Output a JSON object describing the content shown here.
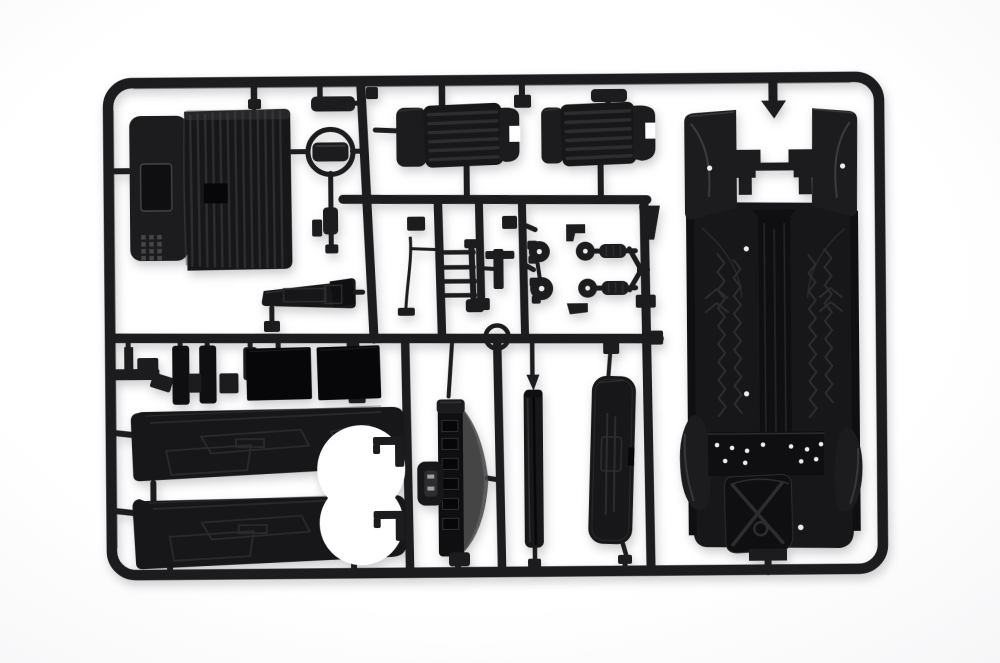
{
  "meta": {
    "description": "Product photograph of a black injection-moulded plastic model kit sprue (parts tree) for a scale model car, holding interior and chassis parts: rear bench seat, steering wheel, two ribbed bucket seats, chassis floor pan with spare wheel well, door card panels, dashboard, console sill, suspension arms, wheel hubs, ladder bracket, trim bars and flat panels, all joined by runner bars inside a rounded rectangular frame on a white background.",
    "image_type": "photograph",
    "visible_text": ""
  },
  "palette": {
    "background": "#f3f3f5",
    "background-center": "#ffffff",
    "plastic": "#1c1c1e",
    "plastic-mid": "#17171a",
    "plastic-dark": "#0f0f11",
    "plastic-deep": "#070709",
    "detail-line": "#2d2d30",
    "sheen": "#454548",
    "hole": "#ededee",
    "shadow": "rgba(0,0,0,0.20)"
  },
  "parts": [
    {
      "id": "sprue-frame",
      "label": "Sprue frame and runners"
    },
    {
      "id": "rear-bench-seat",
      "label": "Rear bench seat (ribbed, with speaker grille)"
    },
    {
      "id": "steering-wheel",
      "label": "Steering wheel with column"
    },
    {
      "id": "bucket-seat-left",
      "label": "Bucket seat (left)"
    },
    {
      "id": "bucket-seat-right",
      "label": "Bucket seat (right)"
    },
    {
      "id": "chassis-floor-pan",
      "label": "Chassis floor pan with wheel arches and spare wheel well"
    },
    {
      "id": "wiper-rod",
      "label": "Thin wiper / antenna rod"
    },
    {
      "id": "ladder-bracket",
      "label": "Ladder-shaped bracket"
    },
    {
      "id": "t-bracket",
      "label": "T-shaped bracket"
    },
    {
      "id": "wheel-hub-pair",
      "label": "Wheel hub / knuckle pair"
    },
    {
      "id": "suspension-arm-assembly",
      "label": "Suspension arm assembly with springs"
    },
    {
      "id": "retaining-ring",
      "label": "Retaining ring"
    },
    {
      "id": "center-console-sill",
      "label": "Centre console / sill piece"
    },
    {
      "id": "trim-clips",
      "label": "Small trim clips and pillar bars"
    },
    {
      "id": "flat-panel-1",
      "label": "Flat square panel (left)"
    },
    {
      "id": "flat-panel-2",
      "label": "Flat square panel (right)"
    },
    {
      "id": "door-panel-upper",
      "label": "Door card panel (upper)"
    },
    {
      "id": "door-panel-lower",
      "label": "Door card panel (lower)"
    },
    {
      "id": "door-hooks",
      "label": "Door hook brackets"
    },
    {
      "id": "dashboard",
      "label": "Dashboard with gauge column and bracket"
    },
    {
      "id": "sill-bar",
      "label": "Rocker sill bar"
    },
    {
      "id": "cover-panel",
      "label": "Rounded cover panel"
    }
  ]
}
